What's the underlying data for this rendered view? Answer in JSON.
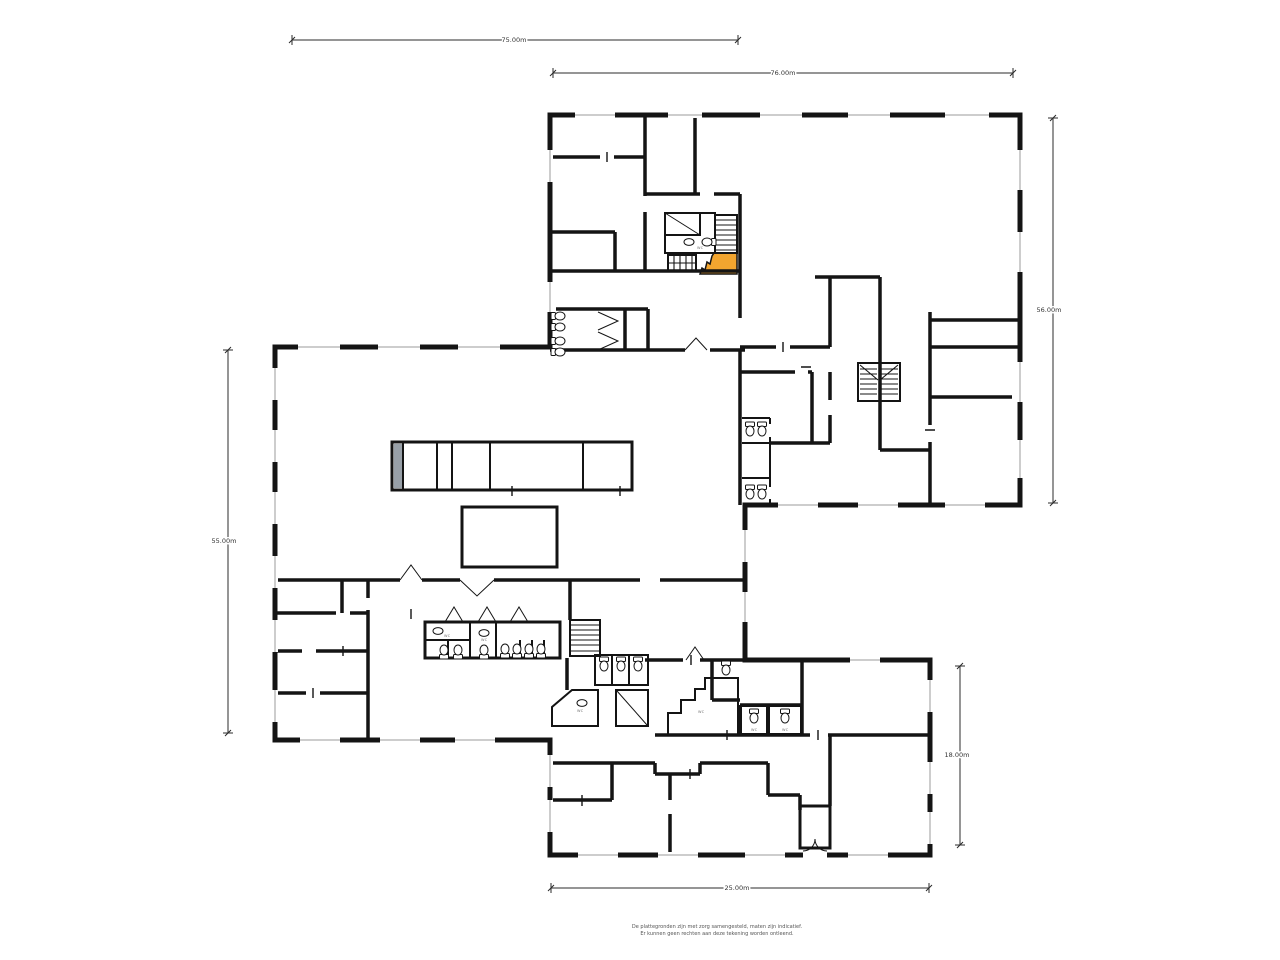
{
  "document": {
    "type": "architectural-floor-plan",
    "background": "#ffffff"
  },
  "palette": {
    "floor_fill": "#f2ddb4",
    "wet_room_fill": "#cfdde9",
    "accent_orange": "#f2a52f",
    "wall_color": "#141414",
    "counter_gray": "#98a0a8",
    "dimension_line": "#2b2b2b",
    "dimension_text": "#333333",
    "footer_text": "#555555"
  },
  "dimensions": {
    "top_left": {
      "label": "75.00m"
    },
    "top_right": {
      "label": "76.00m"
    },
    "right": {
      "label": "56.00m"
    },
    "left": {
      "label": "55.00m"
    },
    "bottom_right": {
      "label": "18.00m"
    },
    "bottom": {
      "label": "25.00m"
    }
  },
  "rooms": {
    "wc_label": "wc"
  },
  "footer": {
    "line1": "De plattegronden zijn met zorg samengesteld, maten zijn indicatief.",
    "line2": "Er kunnen geen rechten aan deze tekening worden ontleend."
  }
}
